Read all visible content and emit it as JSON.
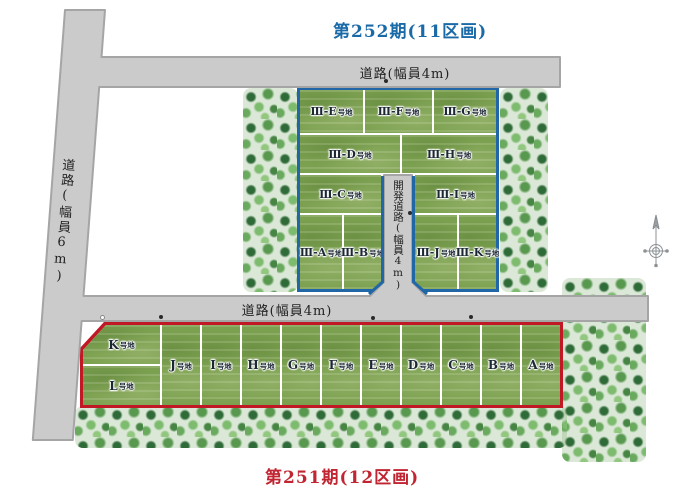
{
  "phase252": {
    "title": "第252期(11区画)",
    "title_color": "#1a6aa8",
    "border_color": "#2166a6",
    "suffix": "号地",
    "plots": [
      {
        "label": "Ⅲ-E"
      },
      {
        "label": "Ⅲ-F"
      },
      {
        "label": "Ⅲ-G"
      },
      {
        "label": "Ⅲ-D"
      },
      {
        "label": "Ⅲ-H"
      },
      {
        "label": "Ⅲ-C"
      },
      {
        "label": "Ⅲ-I"
      },
      {
        "label": "Ⅲ-A"
      },
      {
        "label": "Ⅲ-B"
      },
      {
        "label": "Ⅲ-J"
      },
      {
        "label": "Ⅲ-K"
      }
    ]
  },
  "phase251": {
    "title": "第251期(12区画)",
    "title_color": "#c02531",
    "border_color": "#c01824",
    "suffix": "号地",
    "plots": [
      {
        "label": "K"
      },
      {
        "label": "L"
      },
      {
        "label": "J"
      },
      {
        "label": "I"
      },
      {
        "label": "H"
      },
      {
        "label": "G"
      },
      {
        "label": "F"
      },
      {
        "label": "E"
      },
      {
        "label": "D"
      },
      {
        "label": "C"
      },
      {
        "label": "B"
      },
      {
        "label": "A"
      }
    ]
  },
  "roads": {
    "top": "道路(幅員4m)",
    "left": "道路(幅員6m)",
    "middle": "道路(幅員4m)",
    "development": "開発道路(幅員4m)"
  },
  "colors": {
    "road_fill": "#cbcbcb",
    "road_edge": "#a5a5a5",
    "grass": "#7ba04f"
  }
}
